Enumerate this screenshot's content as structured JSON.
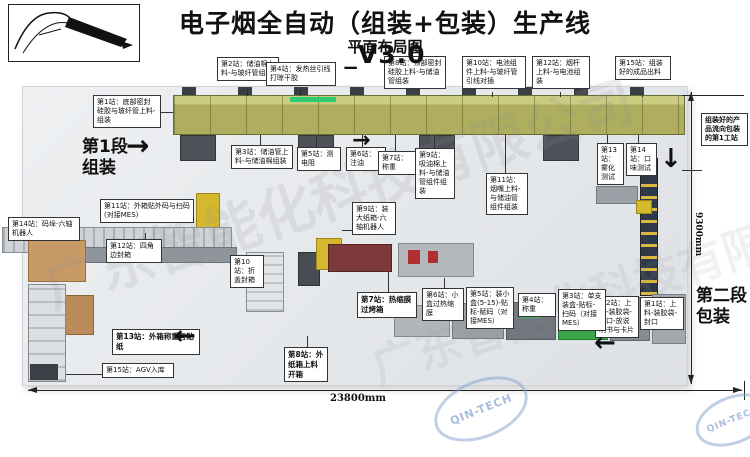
{
  "header": {
    "title": "电子烟全自动（组装+包装）生产线_V3.0",
    "subtitle": "平面布局图"
  },
  "stage1": {
    "line1": "第1段",
    "line2": "组装"
  },
  "stage2": {
    "line1": "第二段",
    "line2": "包装"
  },
  "flow_note": "组装好的产品流向包装的第1工站",
  "dimensions": {
    "bottom": "23800mm",
    "right": "9300mm"
  },
  "watermark": {
    "logo_text": "QIN-TECH",
    "company_text": "广东智能化科技有限公司"
  },
  "icons": {
    "arrow_right": "→",
    "arrow_left": "←",
    "arrow_down": "↓"
  },
  "assembly_stations": [
    {
      "label": "第1站：底部密封硅胶与玻纤管上料-组装"
    },
    {
      "label": "第2站：储油棉上料-与玻纤管组装"
    },
    {
      "label": "第3站：储油管上料-与储油棉组装"
    },
    {
      "label": "第4站：发热丝引线打晾干胶"
    },
    {
      "label": "第5站：测电阻"
    },
    {
      "label": "第6站：注油"
    },
    {
      "label": "第7站：称重"
    },
    {
      "label": "第8站：顶部密封硅胶上料-与储油管组装"
    },
    {
      "label": "第9站：吸油棉上料-与储油管组件组装"
    },
    {
      "label": "第10站：电池组件上料-与玻纤管引线对插"
    },
    {
      "label": "第11站：烟嘴上料-与储油管组件组装"
    },
    {
      "label": "第12站：烟杆上料-与电池组装"
    },
    {
      "label": "第13站：雾化测试"
    },
    {
      "label": "第14站：口味测试"
    },
    {
      "label": "第15站：组装好的成品出料"
    }
  ],
  "packaging_stations": [
    {
      "label": "第1站：上料-装胶袋-封口"
    },
    {
      "label": "第2站：上料-装胶袋-封口-放说明书与卡片"
    },
    {
      "label": "第3站：单支装盒-贴标-扫码（对接MES）"
    },
    {
      "label": "第4站：称重"
    },
    {
      "label": "第5站：装小盒(5-15)-贴标-赋码（对接MES）"
    },
    {
      "label": "第6站：小盒过热缩膜"
    },
    {
      "label": "第7站：热缩膜过烤箱"
    },
    {
      "label": "第8站：外纸箱上料开箱"
    },
    {
      "label": "第9站：装大纸箱-六轴机器人"
    },
    {
      "label": "第10站：折盖封箱"
    },
    {
      "label": "第11站：外箱贴外码与扫码(对接MES)"
    },
    {
      "label": "第12站：四角边封箱"
    },
    {
      "label": "第13站：外箱称重与贴纸"
    },
    {
      "label": "第14站：码垛-六轴机器人"
    },
    {
      "label": "第15站：AGV入库"
    }
  ]
}
